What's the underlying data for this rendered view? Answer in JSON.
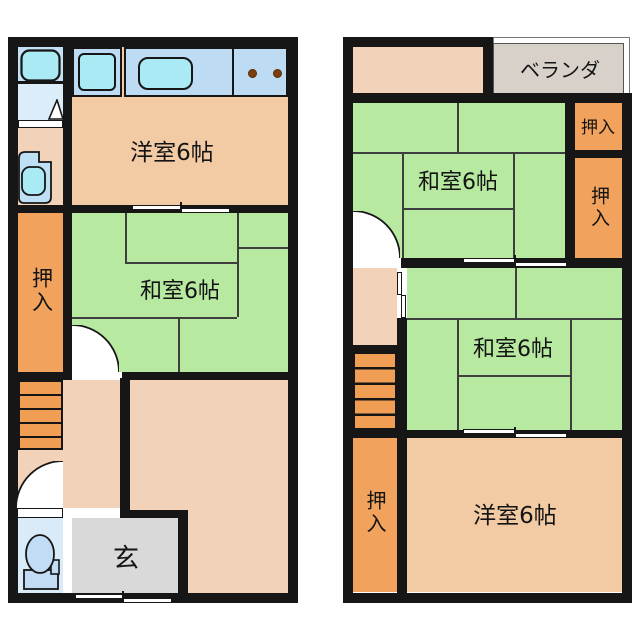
{
  "title": "two-storey apartment floor plan",
  "floor1": {
    "western_room_label": "洋室6帖",
    "japanese_room_label": "和室6帖",
    "closet_label": "押入",
    "entrance_label": "玄"
  },
  "floor2": {
    "veranda_label": "ベランダ",
    "japanese_room_upper_label": "和室6帖",
    "japanese_room_lower_label": "和室6帖",
    "western_room_label": "洋室6帖",
    "closet_top_label": "押入",
    "closet_right_label": "押入",
    "closet_left_label": "押入"
  },
  "colors": {
    "wall": "#161616",
    "tatami_green": "#b7e9a1",
    "tatami_line": "#3e3e3e",
    "room_peach": "#f2caa4",
    "hall_peach": "#f2d2b8",
    "closet_orange": "#f1a25c",
    "stairs_orange": "#ef9e54",
    "counter_blue": "#bddcf4",
    "fixture_cyan": "#a9eaf4",
    "bath_blue": "#c3e0f5",
    "washroom_blue": "#dcedfa",
    "toilet_blue": "#d9ebf9",
    "entrance_gray": "#d9d9d9",
    "veranda_gray": "#d8d1ca",
    "burner_brown": "#7a3e10"
  }
}
